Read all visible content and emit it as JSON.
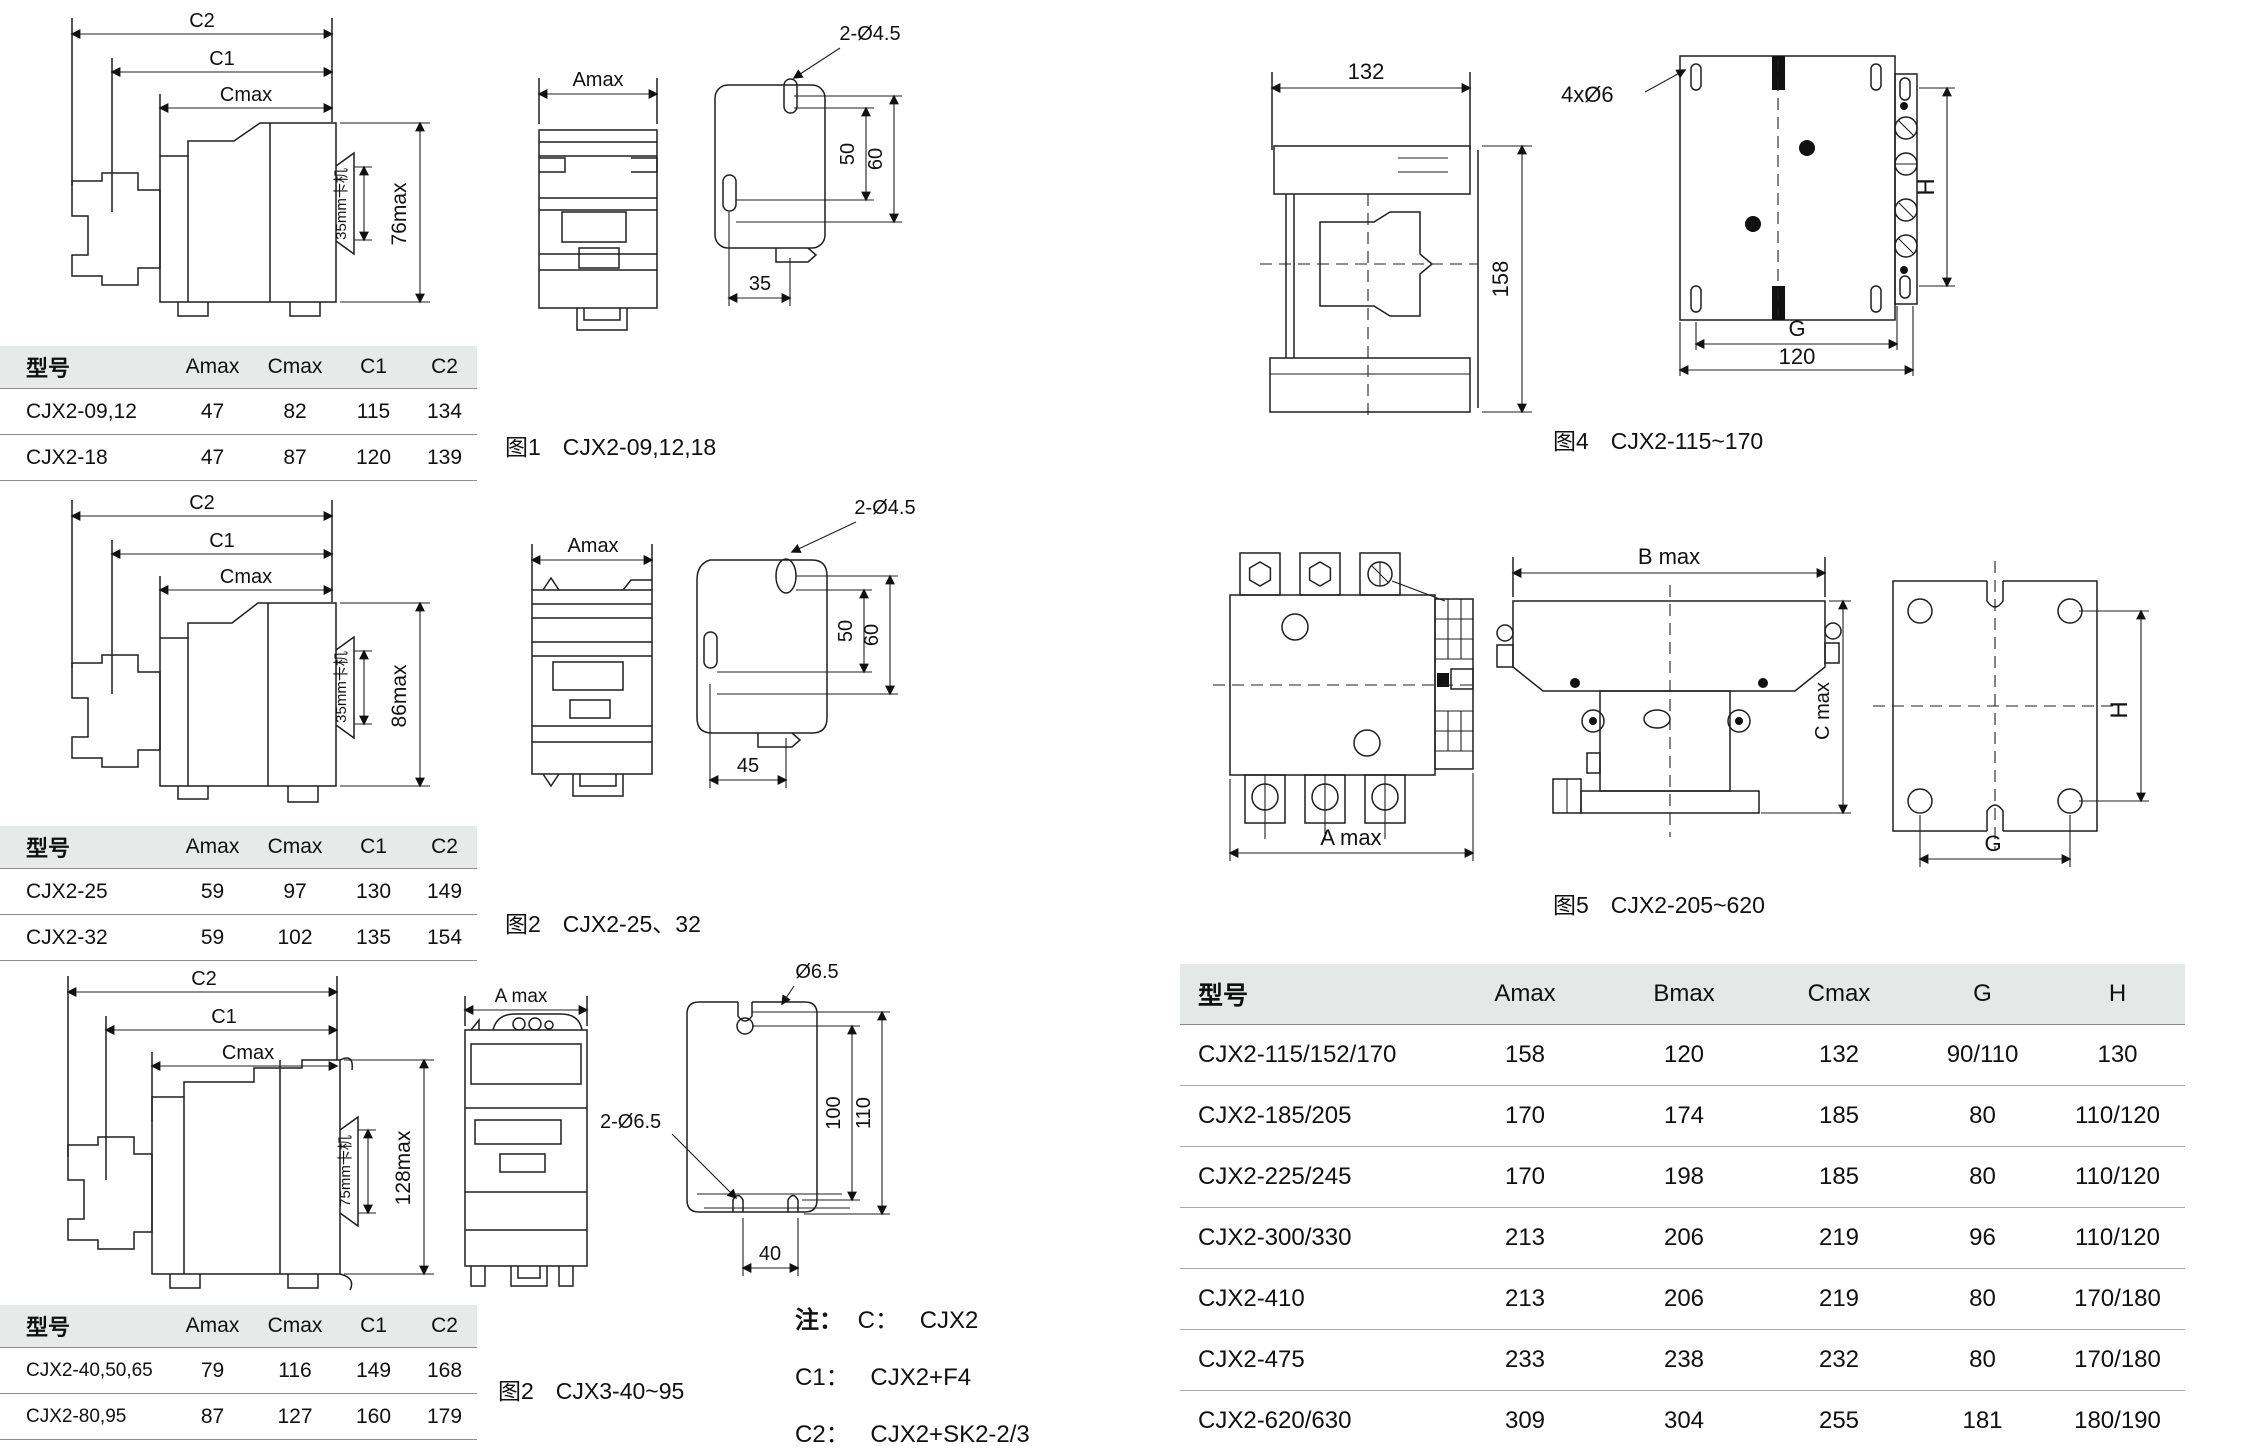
{
  "small_table_headers": [
    "型号",
    "Amax",
    "Cmax",
    "C1",
    "C2"
  ],
  "tables": {
    "t1": {
      "rows": [
        [
          "CJX2-09,12",
          "47",
          "82",
          "115",
          "134"
        ],
        [
          "CJX2-18",
          "47",
          "87",
          "120",
          "139"
        ]
      ]
    },
    "t2": {
      "rows": [
        [
          "CJX2-25",
          "59",
          "97",
          "130",
          "149"
        ],
        [
          "CJX2-32",
          "59",
          "102",
          "135",
          "154"
        ]
      ]
    },
    "t3": {
      "rows": [
        [
          "CJX2-40,50,65",
          "79",
          "116",
          "149",
          "168"
        ],
        [
          "CJX2-80,95",
          "87",
          "127",
          "160",
          "179"
        ]
      ]
    }
  },
  "big_table": {
    "headers": [
      "型号",
      "Amax",
      "Bmax",
      "Cmax",
      "G",
      "H"
    ],
    "rows": [
      [
        "CJX2-115/152/170",
        "158",
        "120",
        "132",
        "90/110",
        "130"
      ],
      [
        "CJX2-185/205",
        "170",
        "174",
        "185",
        "80",
        "110/120"
      ],
      [
        "CJX2-225/245",
        "170",
        "198",
        "185",
        "80",
        "110/120"
      ],
      [
        "CJX2-300/330",
        "213",
        "206",
        "219",
        "96",
        "110/120"
      ],
      [
        "CJX2-410",
        "213",
        "206",
        "219",
        "80",
        "170/180"
      ],
      [
        "CJX2-475",
        "233",
        "238",
        "232",
        "80",
        "170/180"
      ],
      [
        "CJX2-620/630",
        "309",
        "304",
        "255",
        "181",
        "180/190"
      ]
    ]
  },
  "figures": {
    "fig1": {
      "cap_no": "图1",
      "cap_text": "CJX2-09,12,18",
      "c2": "C2",
      "c1": "C1",
      "cmax": "Cmax",
      "h": "76max",
      "rail": "35mm卡机",
      "front_w": "Amax",
      "holes": "2-Ø4.5",
      "v1": "50",
      "v2": "60",
      "hdist": "35"
    },
    "fig2": {
      "cap_no": "图2",
      "cap_text": "CJX2-25、32",
      "c2": "C2",
      "c1": "C1",
      "cmax": "Cmax",
      "h": "86max",
      "rail": "35mm卡机",
      "front_w": "Amax",
      "holes": "2-Ø4.5",
      "v1": "50",
      "v2": "60",
      "hdist": "45"
    },
    "fig3": {
      "cap_no": "图2",
      "cap_text": "CJX3-40~95",
      "c2": "C2",
      "c1": "C1",
      "cmax": "Cmax",
      "h": "128max",
      "rail": "75mm卡机",
      "front_w": "A max",
      "hole_top": "Ø6.5",
      "holes": "2-Ø6.5",
      "v1": "100",
      "v2": "110",
      "hdist": "40"
    },
    "fig4": {
      "cap_no": "图4",
      "cap_text": "CJX2-115~170",
      "w": "132",
      "h": "158",
      "holes": "4xØ6",
      "dim_h": "H",
      "dim_g": "G",
      "dim_g2": "120"
    },
    "fig5": {
      "cap_no": "图5",
      "cap_text": "CJX2-205~620",
      "a": "A max",
      "b": "B max",
      "c": "C max",
      "dim_h": "H",
      "dim_g": "G"
    }
  },
  "notes": {
    "label": "注：",
    "items": [
      {
        "k": "C：",
        "v": "CJX2"
      },
      {
        "k": "C1：",
        "v": "CJX2+F4"
      },
      {
        "k": "C2：",
        "v": "CJX2+SK2-2/3"
      }
    ]
  }
}
